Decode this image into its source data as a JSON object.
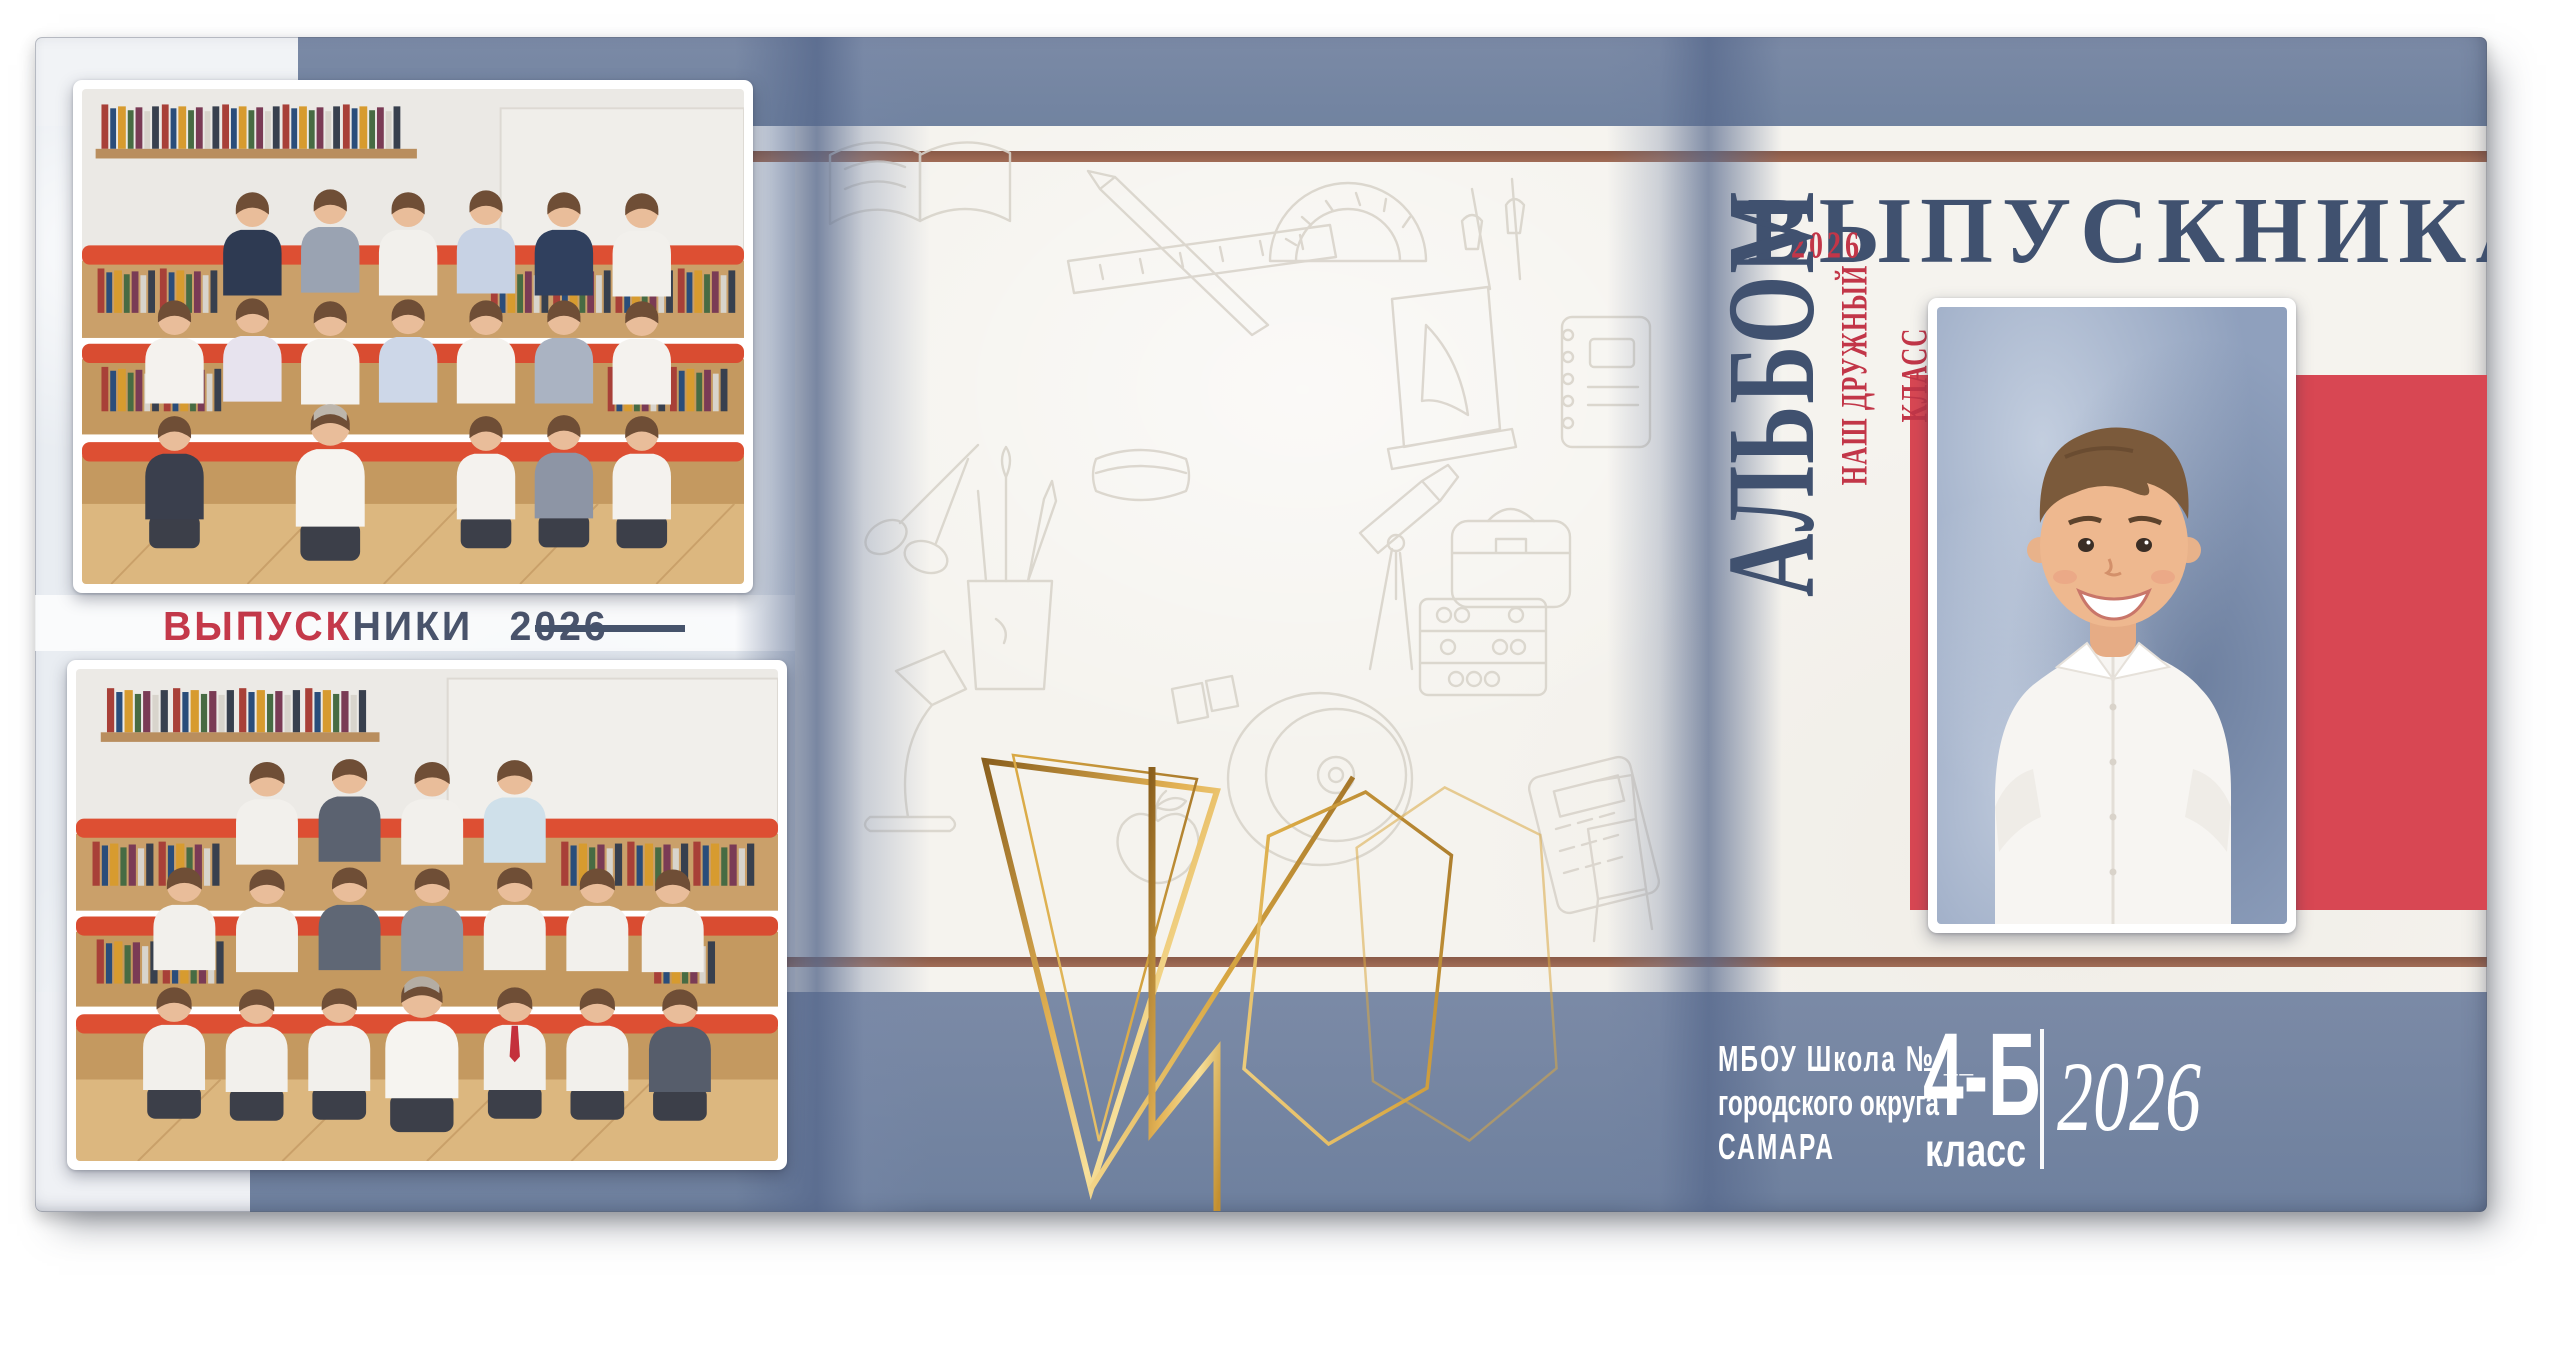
{
  "cover": {
    "back": {
      "caption_highlight": "ВЫПУСК",
      "caption_rest": "НИКИ",
      "caption_year": "2026"
    },
    "front": {
      "title": "ВЫПУСКНИКА",
      "album_word": "АЛЬБОМ",
      "year_badge": "2026",
      "tagline": "НАШ ДРУЖНЫЙ КЛАСС",
      "school_line1": "МБОУ Школа № __",
      "school_line2": "городского округа",
      "school_line3": "САМАРА",
      "class_code": "4-Б",
      "class_word": "класс",
      "year": "2026"
    }
  },
  "colors": {
    "band_blue": "#7183a0",
    "fold_blue": "#566890",
    "rule_brown": "#9b6752",
    "accent_red": "#d84753",
    "text_red": "#c23648",
    "navy": "#40516f",
    "caption_dark": "#49536b",
    "gold": "#d9a843",
    "paper": "#f5f3ee",
    "marble": "#e9edf2"
  },
  "doodle_icons": [
    "open-book",
    "pencil",
    "ruler",
    "protractor",
    "pen-tools",
    "book-stand",
    "spiral-notebook",
    "scissors",
    "brush-cup",
    "eraser",
    "cd-disc",
    "telescope",
    "desk-lamp",
    "apple",
    "abacus",
    "school-bag",
    "calculator",
    "chair"
  ]
}
